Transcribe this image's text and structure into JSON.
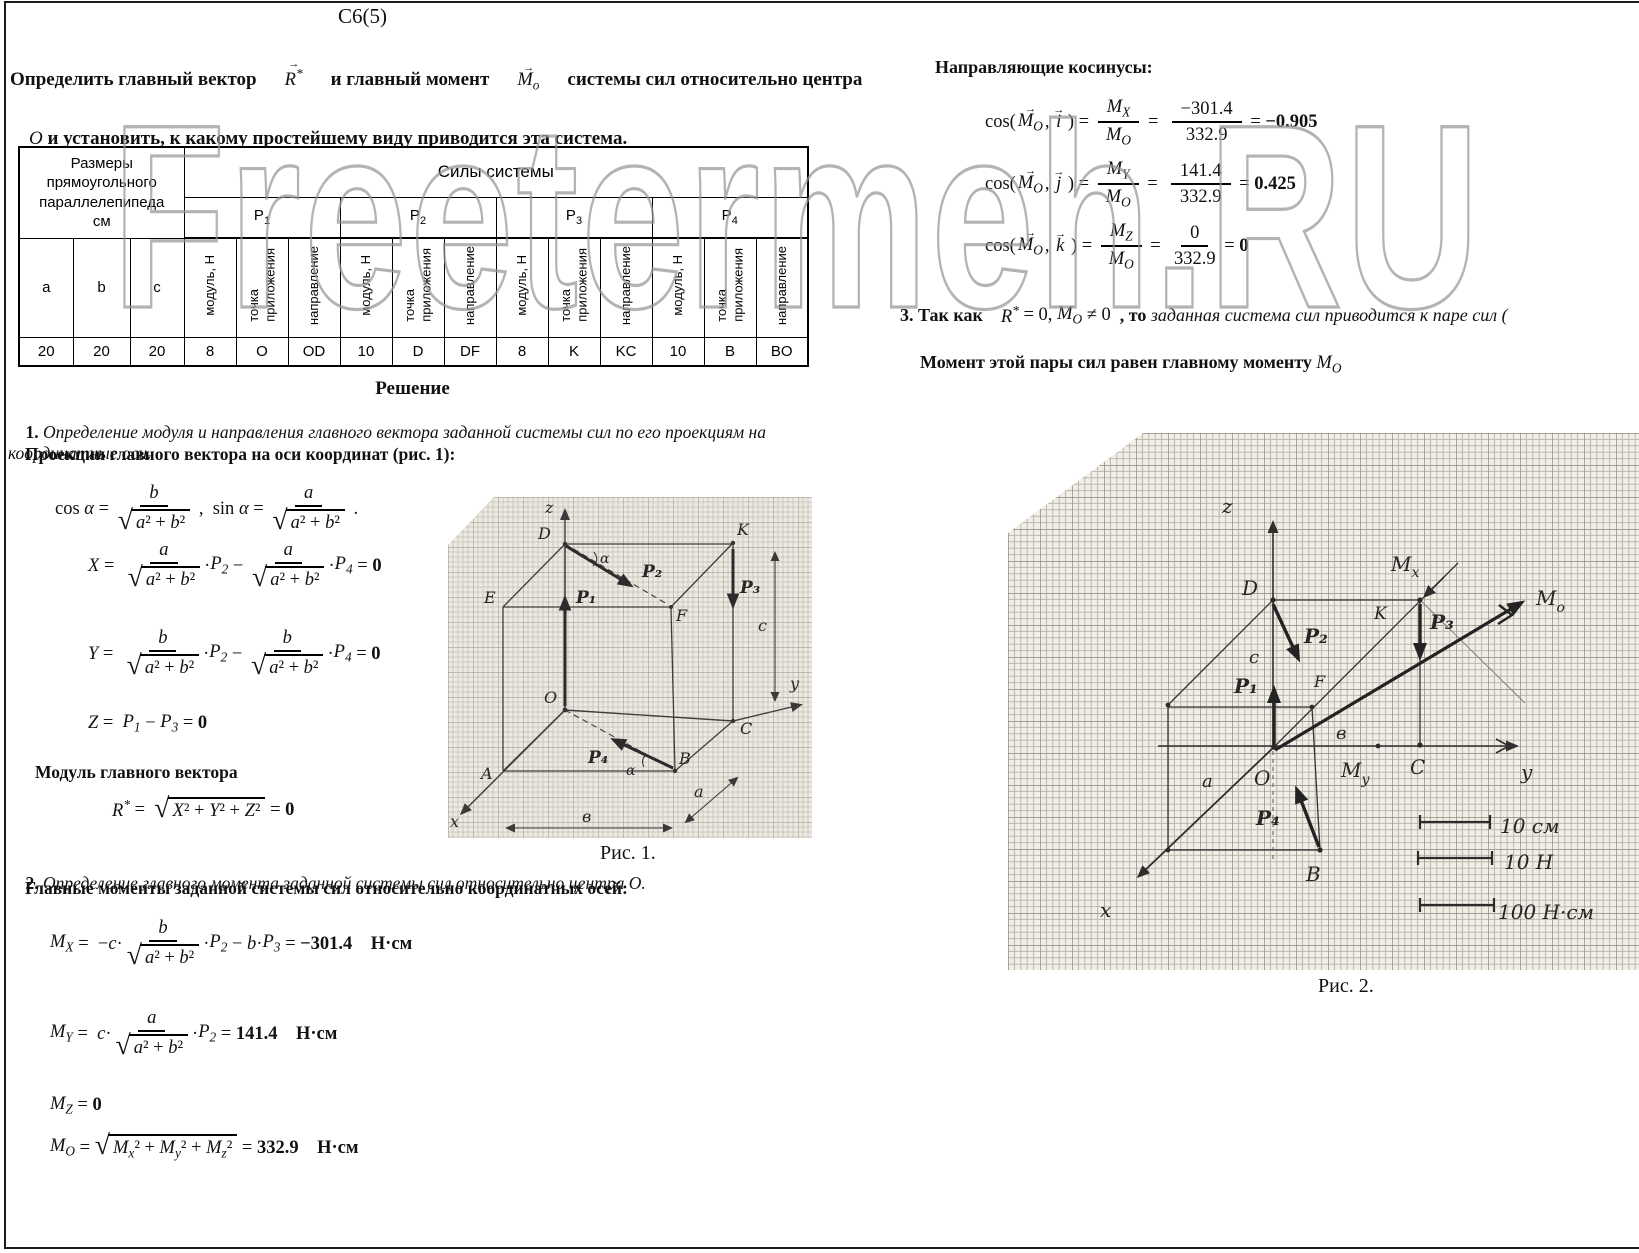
{
  "page": {
    "title": "С6(5)"
  },
  "watermark": {
    "text": "Freetermeh.RU"
  },
  "problem": {
    "p1a": "Определить главный вектор",
    "p1b": "и главный момент",
    "p1c": "системы сил относительно центра",
    "o": "О ",
    "and": "и ",
    "rest": "установить, к какому простейшему виду приводится эта система."
  },
  "table": {
    "size_header": "Размеры\nпрямоугольного\nпараллелепипеда\nсм",
    "forces_header": "Силы системы",
    "groups": [
      [
        "P",
        "1"
      ],
      [
        "P",
        "2"
      ],
      [
        "P",
        "3"
      ],
      [
        "P",
        "4"
      ]
    ],
    "sub_cols": [
      "модуль, Н",
      "точка\nприложения",
      "направление"
    ],
    "size_cols": [
      "a",
      "b",
      "c"
    ],
    "row": [
      "20",
      "20",
      "20",
      "8",
      "O",
      "OD",
      "10",
      "D",
      "DF",
      "8",
      "K",
      "KC",
      "10",
      "B",
      "BO"
    ]
  },
  "solution": {
    "heading": "Решение",
    "s1n": "1. ",
    "s1": "Определение модуля и направления главного вектора заданной системы сил по его проекциям на координатные оси.",
    "proj": "Проекции главного вектора на оси координат (рис. 1):",
    "mod": "Модуль главного вектора",
    "s2n": "2. ",
    "s2": "Определение главного момента заданной системы сил относительно центра О.",
    "mom": "Главные моменты заданной системы сил относительно координатных осей:",
    "fig1_caption": "Рис. 1.",
    "fig2_caption": "Рис. 2."
  },
  "right": {
    "cosines": "Направляющие косинусы:",
    "s3a": "3. Так как    ",
    "s3b": "  , то ",
    "s3c": "заданная система сил приводится к паре сил (",
    "pair": "Момент этой пары сил равен главному моменту "
  },
  "fx": {
    "probR": [
      {
        "t": "vec",
        "b": "R",
        "sp": "*"
      }
    ],
    "probM": [
      {
        "t": "vec",
        "b": "M",
        "s": "о"
      }
    ],
    "cos_alpha": [
      {
        "t": "x",
        "v": "cos "
      },
      {
        "t": "x",
        "v": "α",
        "i": 1
      },
      {
        "t": "x",
        "v": " = "
      },
      {
        "t": "f",
        "n": [
          {
            "t": "x",
            "v": "b",
            "i": 1
          }
        ],
        "d": [
          {
            "t": "r",
            "c": [
              {
                "t": "x",
                "v": "a",
                "i": 1
              },
              {
                "t": "x",
                "v": "² + "
              },
              {
                "t": "x",
                "v": "b",
                "i": 1
              },
              {
                "t": "x",
                "v": "²"
              }
            ]
          }
        ]
      },
      {
        "t": "x",
        "v": " ,  sin "
      },
      {
        "t": "x",
        "v": "α",
        "i": 1
      },
      {
        "t": "x",
        "v": " = "
      },
      {
        "t": "f",
        "n": [
          {
            "t": "x",
            "v": "a",
            "i": 1
          }
        ],
        "d": [
          {
            "t": "r",
            "c": [
              {
                "t": "x",
                "v": "a",
                "i": 1
              },
              {
                "t": "x",
                "v": "² + "
              },
              {
                "t": "x",
                "v": "b",
                "i": 1
              },
              {
                "t": "x",
                "v": "²"
              }
            ]
          }
        ]
      },
      {
        "t": "x",
        "v": " ."
      }
    ],
    "X": [
      {
        "t": "x",
        "v": "X",
        "i": 1
      },
      {
        "t": "x",
        "v": " =  "
      },
      {
        "t": "f",
        "n": [
          {
            "t": "x",
            "v": "a",
            "i": 1
          }
        ],
        "d": [
          {
            "t": "r",
            "c": [
              {
                "t": "x",
                "v": "a",
                "i": 1
              },
              {
                "t": "x",
                "v": "² + "
              },
              {
                "t": "x",
                "v": "b",
                "i": 1
              },
              {
                "t": "x",
                "v": "²"
              }
            ]
          }
        ]
      },
      {
        "t": "x",
        "v": "·"
      },
      {
        "t": "sb",
        "b": "P",
        "s": "2"
      },
      {
        "t": "x",
        "v": " − "
      },
      {
        "t": "f",
        "n": [
          {
            "t": "x",
            "v": "a",
            "i": 1
          }
        ],
        "d": [
          {
            "t": "r",
            "c": [
              {
                "t": "x",
                "v": "a",
                "i": 1
              },
              {
                "t": "x",
                "v": "² + "
              },
              {
                "t": "x",
                "v": "b",
                "i": 1
              },
              {
                "t": "x",
                "v": "²"
              }
            ]
          }
        ]
      },
      {
        "t": "x",
        "v": "·"
      },
      {
        "t": "sb",
        "b": "P",
        "s": "4"
      },
      {
        "t": "x",
        "v": " = "
      },
      {
        "t": "x",
        "v": "0",
        "b": 1
      }
    ],
    "Y": [
      {
        "t": "x",
        "v": "Y",
        "i": 1
      },
      {
        "t": "x",
        "v": " =  "
      },
      {
        "t": "f",
        "n": [
          {
            "t": "x",
            "v": "b",
            "i": 1
          }
        ],
        "d": [
          {
            "t": "r",
            "c": [
              {
                "t": "x",
                "v": "a",
                "i": 1
              },
              {
                "t": "x",
                "v": "² + "
              },
              {
                "t": "x",
                "v": "b",
                "i": 1
              },
              {
                "t": "x",
                "v": "²"
              }
            ]
          }
        ]
      },
      {
        "t": "x",
        "v": "·"
      },
      {
        "t": "sb",
        "b": "P",
        "s": "2"
      },
      {
        "t": "x",
        "v": " − "
      },
      {
        "t": "f",
        "n": [
          {
            "t": "x",
            "v": "b",
            "i": 1
          }
        ],
        "d": [
          {
            "t": "r",
            "c": [
              {
                "t": "x",
                "v": "a",
                "i": 1
              },
              {
                "t": "x",
                "v": "² + "
              },
              {
                "t": "x",
                "v": "b",
                "i": 1
              },
              {
                "t": "x",
                "v": "²"
              }
            ]
          }
        ]
      },
      {
        "t": "x",
        "v": "·"
      },
      {
        "t": "sb",
        "b": "P",
        "s": "4"
      },
      {
        "t": "x",
        "v": " = "
      },
      {
        "t": "x",
        "v": "0",
        "b": 1
      }
    ],
    "Z": [
      {
        "t": "x",
        "v": "Z",
        "i": 1
      },
      {
        "t": "x",
        "v": " =  "
      },
      {
        "t": "sb",
        "b": "P",
        "s": "1"
      },
      {
        "t": "x",
        "v": " − "
      },
      {
        "t": "sb",
        "b": "P",
        "s": "3"
      },
      {
        "t": "x",
        "v": " = "
      },
      {
        "t": "x",
        "v": "0",
        "b": 1
      }
    ],
    "R": [
      {
        "t": "sp",
        "b": "R",
        "s": "*"
      },
      {
        "t": "x",
        "v": " =  "
      },
      {
        "t": "r",
        "c": [
          {
            "t": "x",
            "v": "X",
            "i": 1
          },
          {
            "t": "x",
            "v": "² + "
          },
          {
            "t": "x",
            "v": "Y",
            "i": 1
          },
          {
            "t": "x",
            "v": "² + "
          },
          {
            "t": "x",
            "v": "Z",
            "i": 1
          },
          {
            "t": "x",
            "v": "²"
          }
        ]
      },
      {
        "t": "x",
        "v": " = "
      },
      {
        "t": "x",
        "v": "0",
        "b": 1
      }
    ],
    "MX": [
      {
        "t": "sb",
        "b": "M",
        "s": "X"
      },
      {
        "t": "x",
        "v": " =  −"
      },
      {
        "t": "x",
        "v": "c",
        "i": 1
      },
      {
        "t": "x",
        "v": "·"
      },
      {
        "t": "f",
        "n": [
          {
            "t": "x",
            "v": "b",
            "i": 1
          }
        ],
        "d": [
          {
            "t": "r",
            "c": [
              {
                "t": "x",
                "v": "a",
                "i": 1
              },
              {
                "t": "x",
                "v": "² + "
              },
              {
                "t": "x",
                "v": "b",
                "i": 1
              },
              {
                "t": "x",
                "v": "²"
              }
            ]
          }
        ]
      },
      {
        "t": "x",
        "v": "·"
      },
      {
        "t": "sb",
        "b": "P",
        "s": "2"
      },
      {
        "t": "x",
        "v": " − "
      },
      {
        "t": "x",
        "v": "b",
        "i": 1
      },
      {
        "t": "x",
        "v": "·"
      },
      {
        "t": "sb",
        "b": "P",
        "s": "3"
      },
      {
        "t": "x",
        "v": " = "
      },
      {
        "t": "x",
        "v": "−301.4",
        "b": 1
      },
      {
        "t": "x",
        "v": "    Н·см",
        "b": 1
      }
    ],
    "MY": [
      {
        "t": "sb",
        "b": "M",
        "s": "Y"
      },
      {
        "t": "x",
        "v": " =  "
      },
      {
        "t": "x",
        "v": "c",
        "i": 1
      },
      {
        "t": "x",
        "v": "·"
      },
      {
        "t": "f",
        "n": [
          {
            "t": "x",
            "v": "a",
            "i": 1
          }
        ],
        "d": [
          {
            "t": "r",
            "c": [
              {
                "t": "x",
                "v": "a",
                "i": 1
              },
              {
                "t": "x",
                "v": "² + "
              },
              {
                "t": "x",
                "v": "b",
                "i": 1
              },
              {
                "t": "x",
                "v": "²"
              }
            ]
          }
        ]
      },
      {
        "t": "x",
        "v": "·"
      },
      {
        "t": "sb",
        "b": "P",
        "s": "2"
      },
      {
        "t": "x",
        "v": " = "
      },
      {
        "t": "x",
        "v": "141.4",
        "b": 1
      },
      {
        "t": "x",
        "v": "    Н·см",
        "b": 1
      }
    ],
    "MZ": [
      {
        "t": "sb",
        "b": "M",
        "s": "Z"
      },
      {
        "t": "x",
        "v": " = "
      },
      {
        "t": "x",
        "v": "0",
        "b": 1
      }
    ],
    "MO": [
      {
        "t": "sb",
        "b": "M",
        "s": "O"
      },
      {
        "t": "x",
        "v": " = "
      },
      {
        "t": "r",
        "c": [
          {
            "t": "sb",
            "b": "M",
            "s": "x"
          },
          {
            "t": "x",
            "v": "² + "
          },
          {
            "t": "sb",
            "b": "M",
            "s": "y"
          },
          {
            "t": "x",
            "v": "² + "
          },
          {
            "t": "sb",
            "b": "M",
            "s": "z"
          },
          {
            "t": "x",
            "v": "²"
          }
        ]
      },
      {
        "t": "x",
        "v": " = "
      },
      {
        "t": "x",
        "v": "332.9",
        "b": 1
      },
      {
        "t": "x",
        "v": "    Н·см",
        "b": 1
      }
    ],
    "c1": [
      {
        "t": "x",
        "v": "cos("
      },
      {
        "t": "vec",
        "b": "M",
        "s": "O"
      },
      {
        "t": "x",
        "v": ", "
      },
      {
        "t": "vec",
        "b": "i"
      },
      {
        "t": "x",
        "v": " ) = "
      },
      {
        "t": "f",
        "n": [
          {
            "t": "sb",
            "b": "M",
            "s": "X"
          }
        ],
        "d": [
          {
            "t": "sb",
            "b": "M",
            "s": "O"
          }
        ]
      },
      {
        "t": "x",
        "v": " =  "
      },
      {
        "t": "f",
        "n": [
          {
            "t": "x",
            "v": "−301.4"
          }
        ],
        "d": [
          {
            "t": "x",
            "v": "332.9"
          }
        ]
      },
      {
        "t": "x",
        "v": " = "
      },
      {
        "t": "x",
        "v": "−0.905",
        "b": 1
      }
    ],
    "c2": [
      {
        "t": "x",
        "v": "cos("
      },
      {
        "t": "vec",
        "b": "M",
        "s": "O"
      },
      {
        "t": "x",
        "v": ", "
      },
      {
        "t": "vec",
        "b": "j"
      },
      {
        "t": "x",
        "v": " ) = "
      },
      {
        "t": "f",
        "n": [
          {
            "t": "sb",
            "b": "M",
            "s": "Y"
          }
        ],
        "d": [
          {
            "t": "sb",
            "b": "M",
            "s": "O"
          }
        ]
      },
      {
        "t": "x",
        "v": " =  "
      },
      {
        "t": "f",
        "n": [
          {
            "t": "x",
            "v": "141.4"
          }
        ],
        "d": [
          {
            "t": "x",
            "v": "332.9"
          }
        ]
      },
      {
        "t": "x",
        "v": " = "
      },
      {
        "t": "x",
        "v": "0.425",
        "b": 1
      }
    ],
    "c3": [
      {
        "t": "x",
        "v": "cos("
      },
      {
        "t": "vec",
        "b": "M",
        "s": "O"
      },
      {
        "t": "x",
        "v": ", "
      },
      {
        "t": "vec",
        "b": "k"
      },
      {
        "t": "x",
        "v": " ) = "
      },
      {
        "t": "f",
        "n": [
          {
            "t": "sb",
            "b": "M",
            "s": "Z"
          }
        ],
        "d": [
          {
            "t": "sb",
            "b": "M",
            "s": "O"
          }
        ]
      },
      {
        "t": "x",
        "v": " =  "
      },
      {
        "t": "f",
        "n": [
          {
            "t": "x",
            "v": "0"
          }
        ],
        "d": [
          {
            "t": "x",
            "v": "332.9"
          }
        ]
      },
      {
        "t": "x",
        "v": " = "
      },
      {
        "t": "x",
        "v": "0",
        "b": 1
      }
    ],
    "r3": [
      {
        "t": "sp",
        "b": "R",
        "s": "*"
      },
      {
        "t": "x",
        "v": " = 0, "
      },
      {
        "t": "sb",
        "b": "M",
        "s": "O"
      },
      {
        "t": "x",
        "v": " ≠ 0"
      }
    ],
    "mosym": [
      {
        "t": "sb",
        "b": "M",
        "s": "O"
      }
    ]
  },
  "fig1": {
    "z": "z",
    "D": "D",
    "K": "K",
    "E": "E",
    "F": "F",
    "O": "O",
    "A": "A",
    "B": "B",
    "C": "C",
    "x": "x",
    "y": "y",
    "p1": "P₁",
    "p2": "P₂",
    "p3": "P₃",
    "p4": "P₄",
    "alpha": "α",
    "a": "a",
    "b": "в",
    "c": "c"
  },
  "fig2": {
    "z": "z",
    "D": "D",
    "K": "K",
    "F": "F",
    "O": "O",
    "B": "B",
    "C": "C",
    "x": "x",
    "y": "y",
    "p1": "P₁",
    "p2": "P₂",
    "p3": "P₃",
    "p4": "P₄",
    "a": "a",
    "b": "в",
    "c": "с",
    "m": "M",
    "sub_x": "x",
    "sub_y": "y",
    "sub_o": "o",
    "scale": [
      "10 см",
      "10 Н",
      "100 Н·см"
    ]
  }
}
